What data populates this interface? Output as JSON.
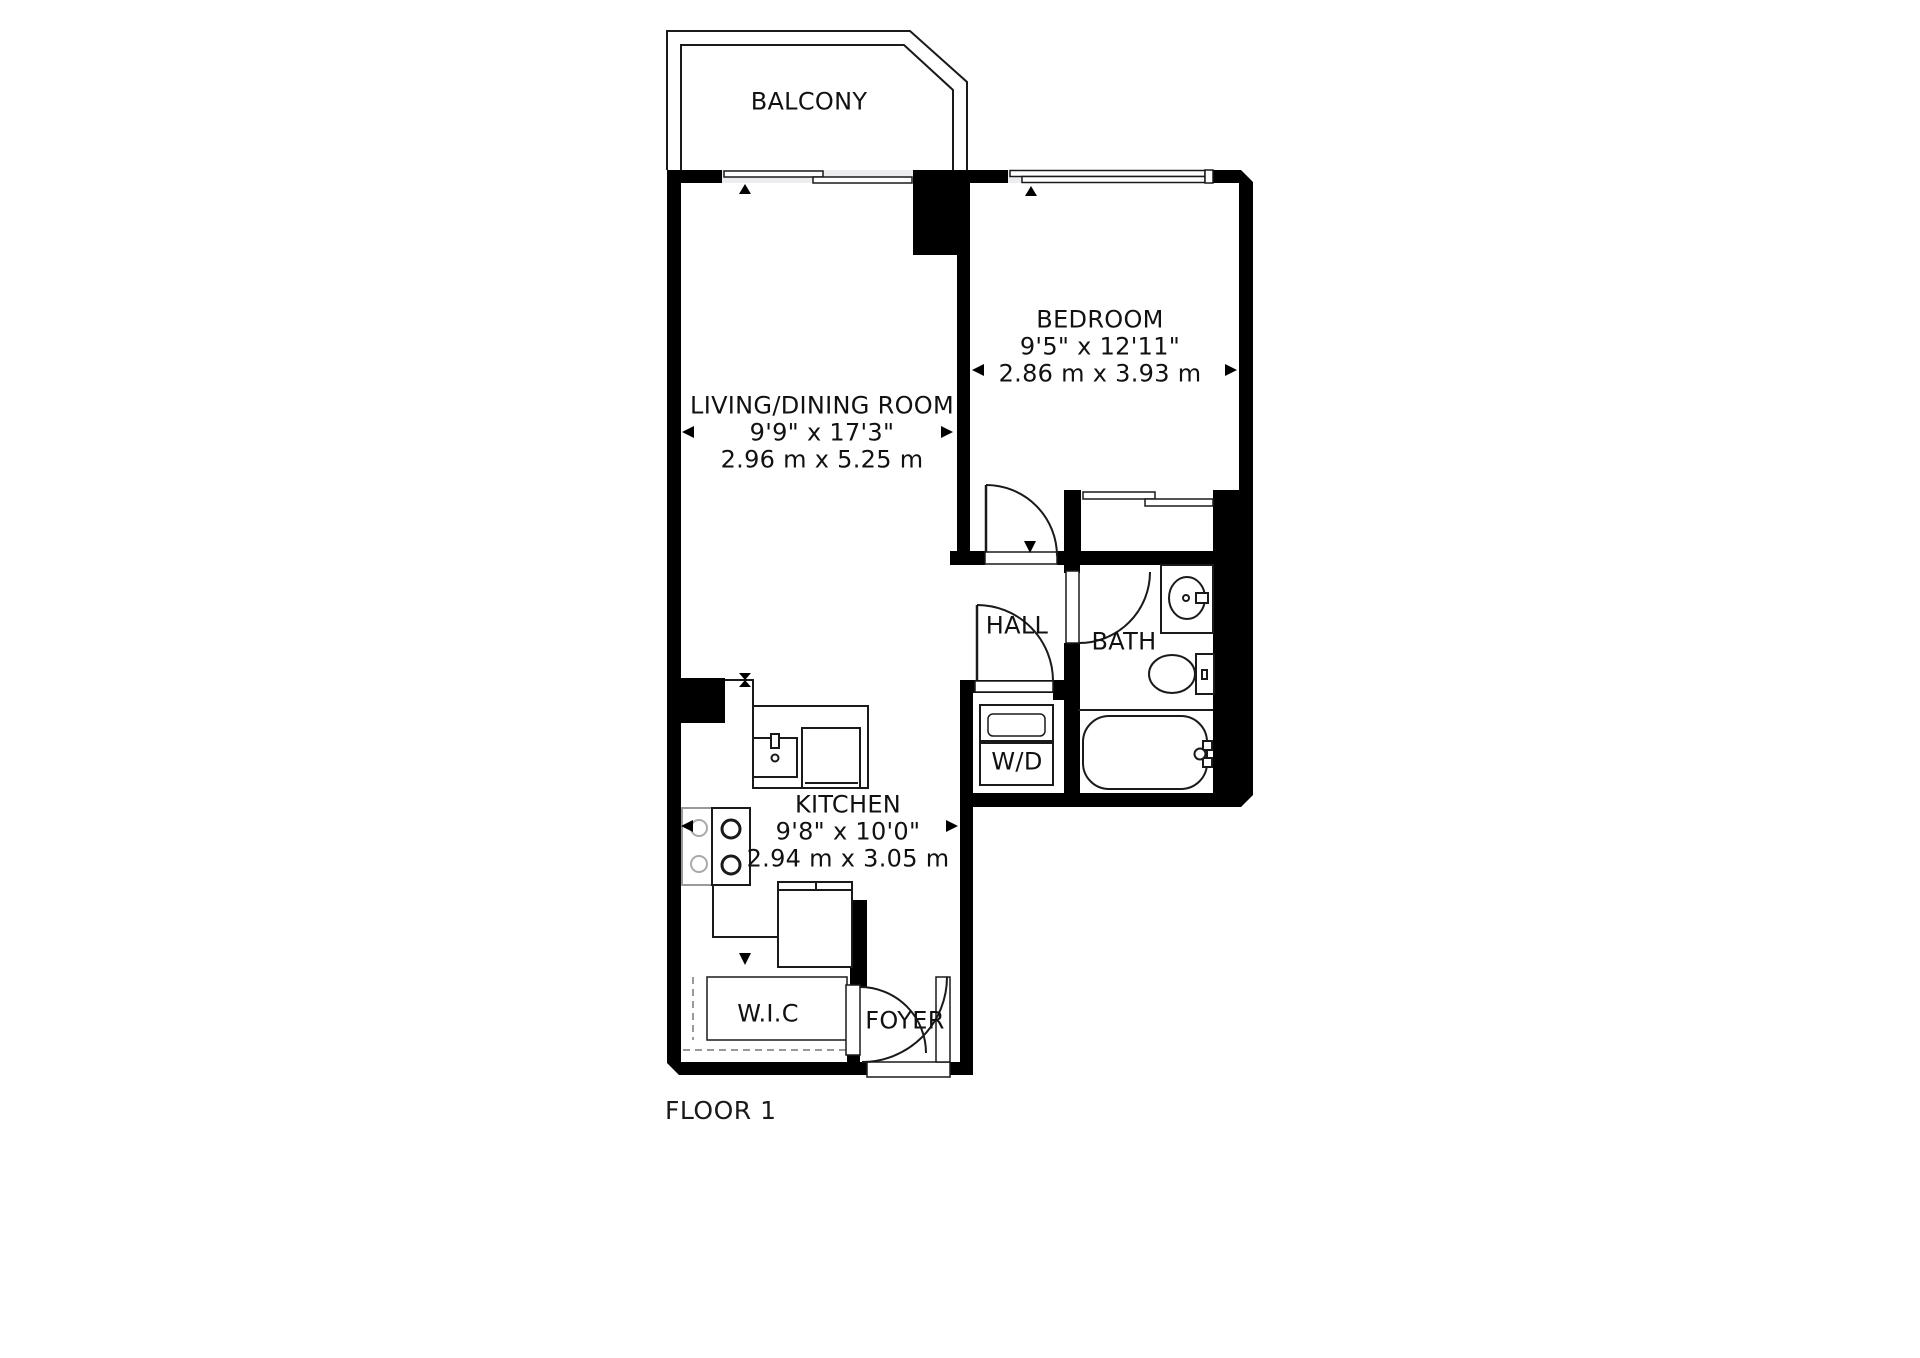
{
  "floor_plan": {
    "floor_label": "FLOOR 1",
    "rooms": [
      {
        "id": "balcony",
        "name": "BALCONY"
      },
      {
        "id": "living_dining",
        "name": "LIVING/DINING ROOM",
        "dim_imperial": "9'9\" x 17'3\"",
        "dim_metric": "2.96 m x 5.25 m"
      },
      {
        "id": "bedroom",
        "name": "BEDROOM",
        "dim_imperial": "9'5\" x 12'11\"",
        "dim_metric": "2.86 m x 3.93 m"
      },
      {
        "id": "kitchen",
        "name": "KITCHEN",
        "dim_imperial": "9'8\" x 10'0\"",
        "dim_metric": "2.94 m x 3.05 m"
      },
      {
        "id": "hall",
        "name": "HALL"
      },
      {
        "id": "bath",
        "name": "BATH"
      },
      {
        "id": "washer_dryer",
        "name": "W/D"
      },
      {
        "id": "walk_in_closet",
        "name": "W.I.C"
      },
      {
        "id": "foyer",
        "name": "FOYER"
      }
    ],
    "colors": {
      "wall": "#000000",
      "line": "#1a1a1a",
      "window_fill": "#ededef",
      "dash_line": "#999999",
      "background": "#ffffff"
    }
  }
}
